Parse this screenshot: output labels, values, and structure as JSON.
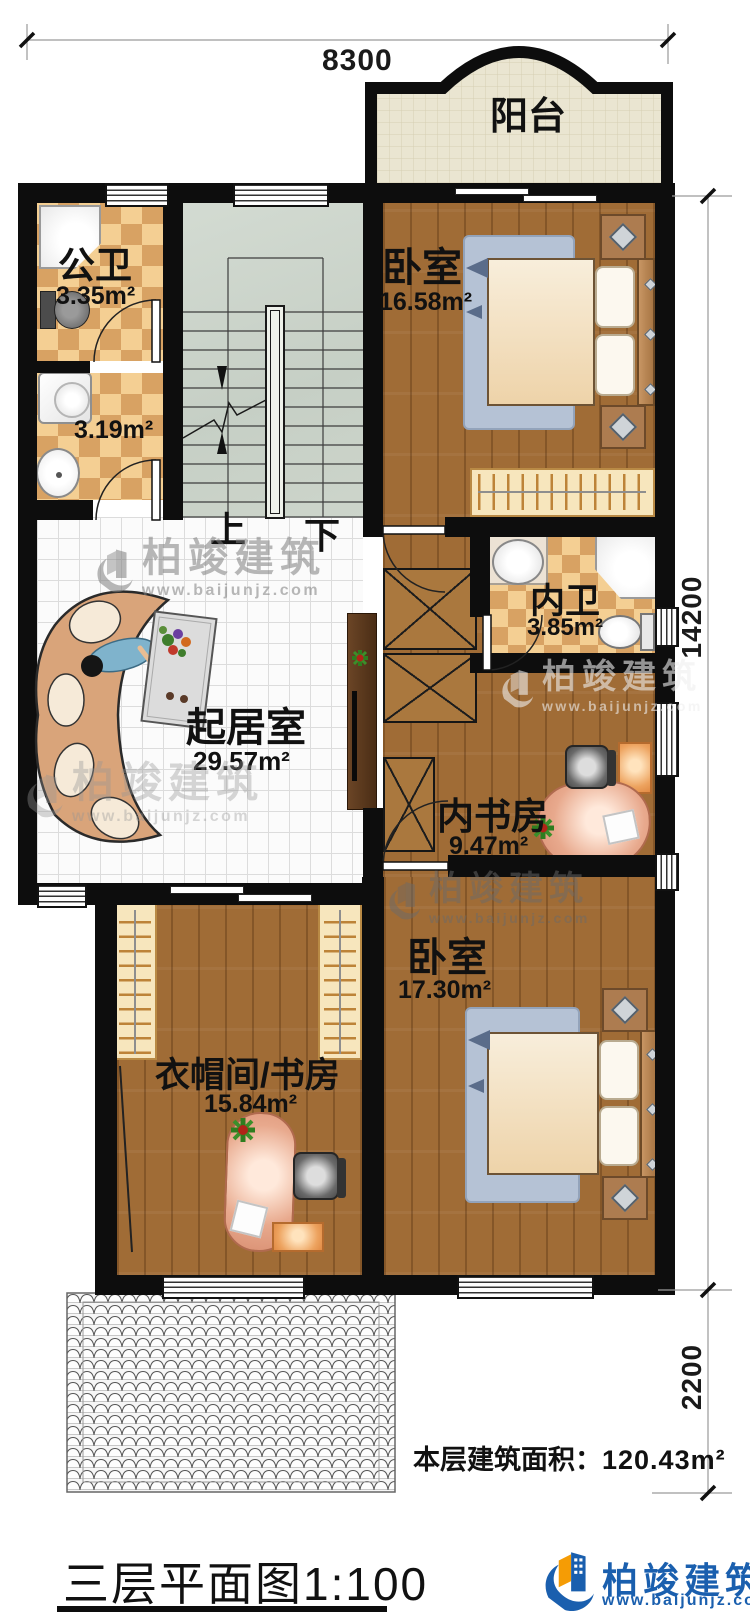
{
  "dimensions": {
    "top": "8300",
    "right_main": "14200",
    "right_lower": "2200"
  },
  "rooms": {
    "balcony": {
      "name": "阳台"
    },
    "public_bath": {
      "name": "公卫",
      "area": "3.35m²"
    },
    "laundry": {
      "area": "3.19m²"
    },
    "bedroom1": {
      "name": "卧室",
      "area": "16.58m²"
    },
    "inner_bath": {
      "name": "内卫",
      "area": "3.85m²"
    },
    "living": {
      "name": "起居室",
      "area": "29.57m²"
    },
    "inner_study": {
      "name": "内书房",
      "area": "9.47m²"
    },
    "bedroom2": {
      "name": "卧室",
      "area": "17.30m²"
    },
    "cloak_study": {
      "name": "衣帽间/书房",
      "area": "15.84m²"
    }
  },
  "stairs": {
    "up": "上",
    "down": "下"
  },
  "footer": {
    "floor_area_label": "本层建筑面积：",
    "floor_area_value": "120.43m²",
    "title": "三层平面图1:100"
  },
  "brand": {
    "name": "柏竣建筑",
    "url": "www.baijunjz.com"
  },
  "watermark": {
    "name": "柏竣建筑",
    "url": "www.baijunjz.com"
  },
  "colors": {
    "brand_blue": "#1a5fae",
    "brand_orange": "#f59c05",
    "wall": "#0d0d0d",
    "wood_floor": "#a06c36",
    "checker_light": "#f4cf93",
    "checker_dark": "#d8a263",
    "stair_floor": "#cdd5cb",
    "balcony_floor": "#eae5d1"
  }
}
